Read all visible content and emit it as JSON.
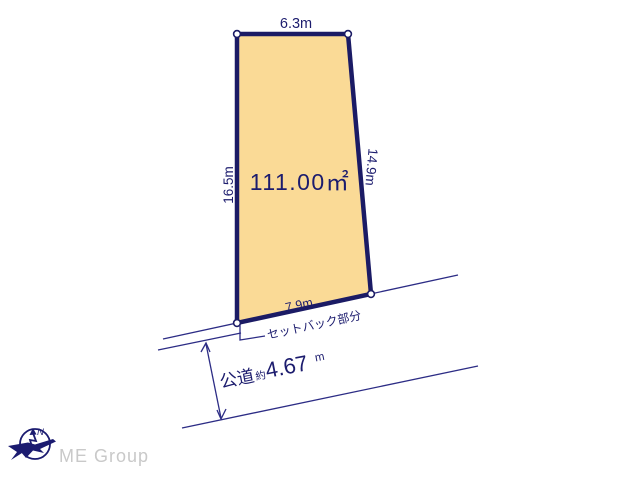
{
  "plot": {
    "area_label": "111.00㎡",
    "edge_top": "6.3m",
    "edge_left": "16.5m",
    "edge_right": "14.9m",
    "edge_bottom": "7.9m"
  },
  "setback": {
    "label": "セットバック部分"
  },
  "road": {
    "name": "公道",
    "approx_prefix": "約",
    "width_value": "4.67",
    "width_unit": "m"
  },
  "compass": {
    "north_label": "N"
  },
  "branding": {
    "company": "ME Group"
  },
  "colors": {
    "plot_fill": "#fada96",
    "border_navy": "#1b1b65",
    "thin_line_navy": "#2c2c85",
    "text_navy": "#1c1c6e",
    "logo_gray": "#c9c9c9",
    "background": "#ffffff"
  }
}
